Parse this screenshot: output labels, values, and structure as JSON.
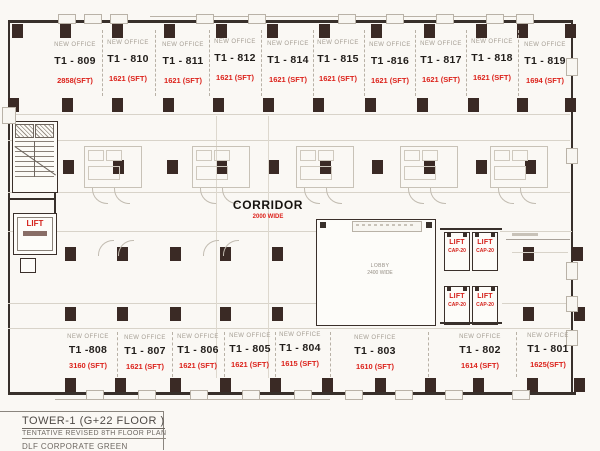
{
  "labels": {
    "new_office": "NEW OFFICE",
    "lift": "LIFT",
    "lift_cap": "CAP-20",
    "corridor": "CORRIDOR",
    "corridor_width": "2000 WIDE",
    "lobby": "LOBBY",
    "lobby_width": "2400 WIDE"
  },
  "offices_top": [
    {
      "unit": "T1 - 809",
      "area": "2858(SFT)"
    },
    {
      "unit": "T1 - 810",
      "area": "1621 (SFT)"
    },
    {
      "unit": "T1 - 811",
      "area": "1621 (SFT)"
    },
    {
      "unit": "T1 - 812",
      "area": "1621 (SFT)"
    },
    {
      "unit": "T1 - 814",
      "area": "1621 (SFT)"
    },
    {
      "unit": "T1 - 815",
      "area": "1621 (SFT)"
    },
    {
      "unit": "T1 -816",
      "area": "1621 (SFT)"
    },
    {
      "unit": "T1 - 817",
      "area": "1621 (SFT)"
    },
    {
      "unit": "T1 - 818",
      "area": "1621 (SFT)"
    },
    {
      "unit": "T1 - 819",
      "area": "1694 (SFT)"
    }
  ],
  "offices_bottom": [
    {
      "unit": "T1 -808",
      "area": "3160 (SFT)"
    },
    {
      "unit": "T1 - 807",
      "area": "1621 (SFT)"
    },
    {
      "unit": "T1 - 806",
      "area": "1621 (SFT)"
    },
    {
      "unit": "T1 - 805",
      "area": "1621 (SFT)"
    },
    {
      "unit": "T1 - 804",
      "area": "1615 (SFT)"
    },
    {
      "unit": "T1 - 803",
      "area": "1610 (SFT)"
    },
    {
      "unit": "T1 - 802",
      "area": "1614 (SFT)"
    },
    {
      "unit": "T1 - 801",
      "area": "1625(SFT)"
    }
  ],
  "title_block": {
    "line1": "TOWER-1  (G+22 FLOOR )",
    "line2": "TENTATIVE  REVISED 8TH  FLOOR  PLAN",
    "line3": "DLF CORPORATE GREEN"
  },
  "colors": {
    "accent_red": "#d4201a",
    "ink": "#38302b",
    "muted_gray": "#a59e94"
  }
}
